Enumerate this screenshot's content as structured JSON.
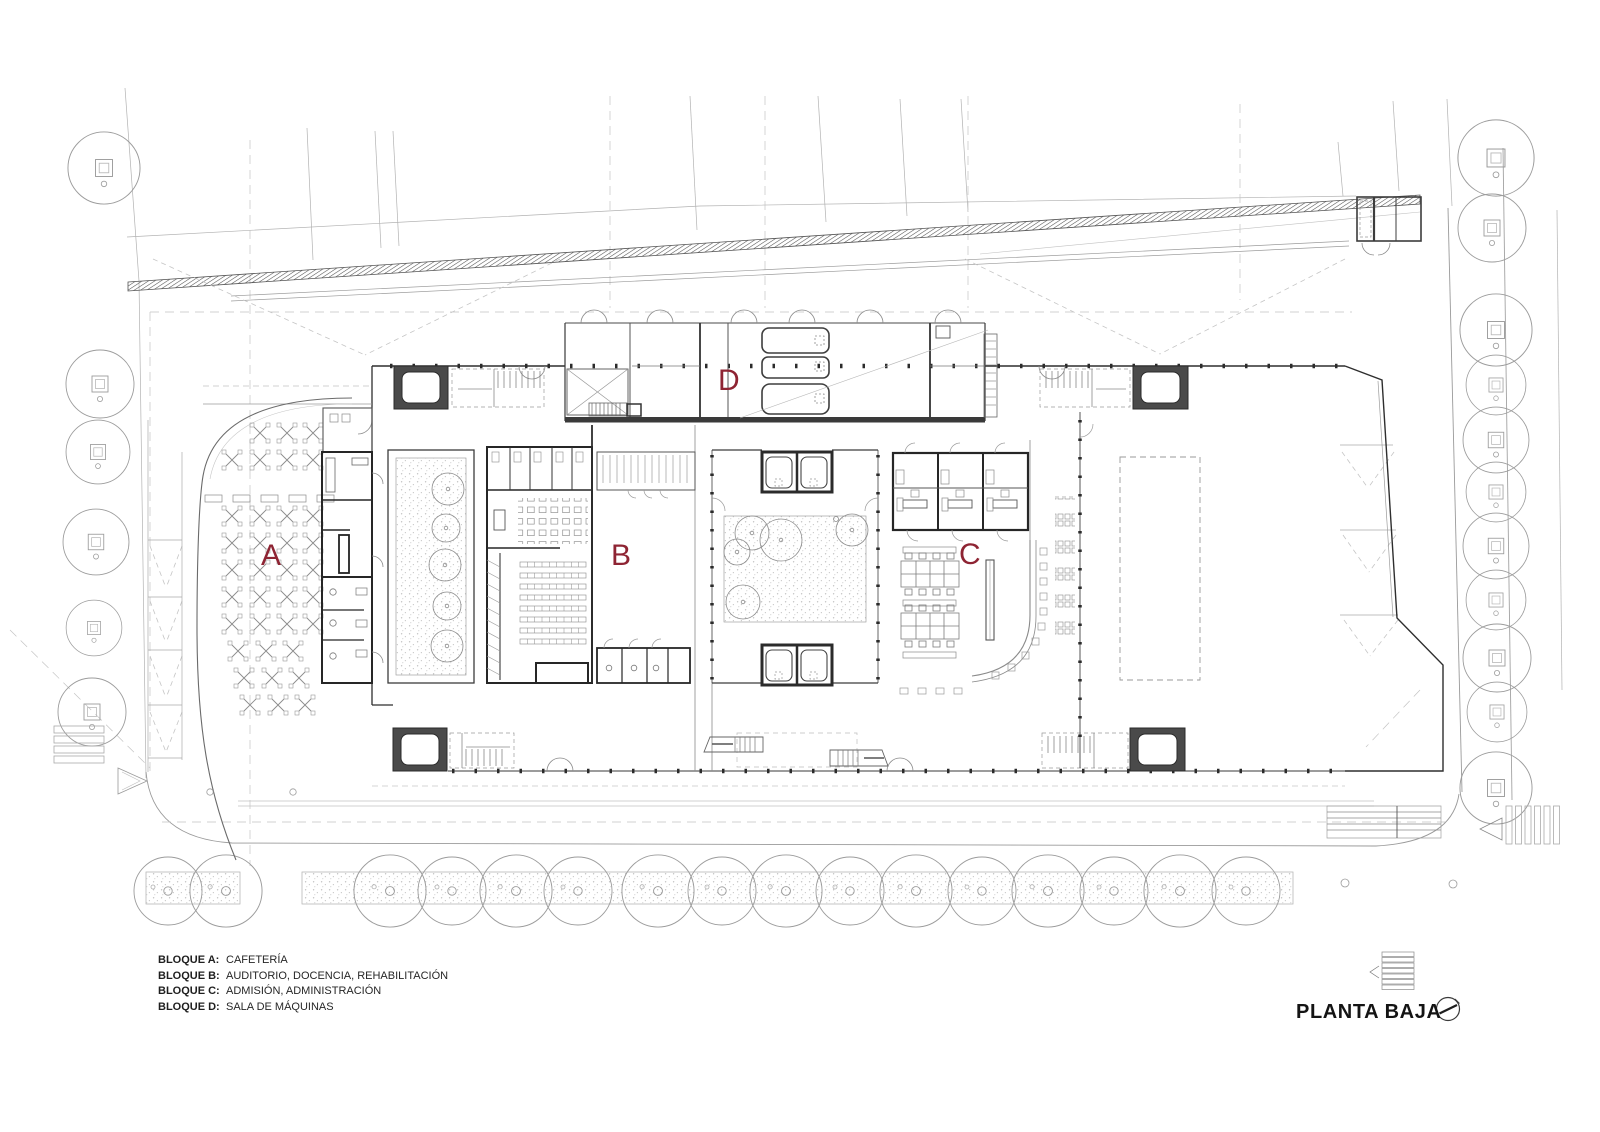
{
  "title": {
    "text": "PLANTA BAJA"
  },
  "plan": {
    "blocks": [
      {
        "letter": "A",
        "label": "BLOQUE A:",
        "description": "CAFETERÍA"
      },
      {
        "letter": "B",
        "label": "BLOQUE B:",
        "description": "AUDITORIO, DOCENCIA, REHABILITACIÓN"
      },
      {
        "letter": "C",
        "label": "BLOQUE C:",
        "description": "ADMISIÓN, ADMINISTRACIÓN"
      },
      {
        "letter": "D",
        "label": "BLOQUE D:",
        "description": "SALA DE MÁQUINAS"
      }
    ]
  },
  "colors": {
    "block_letter": "#8E2433",
    "drawing_ink": "#2E2E2E",
    "context_gray": "#9A9A9A",
    "paper": "#FFFFFF"
  },
  "icons": {
    "north_arrow": "north-arrow-icon"
  }
}
